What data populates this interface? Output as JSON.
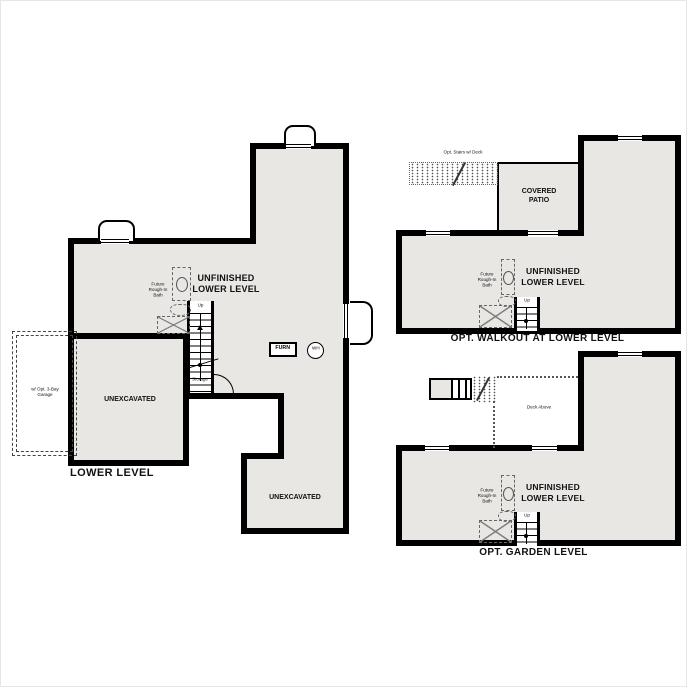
{
  "colors": {
    "wall": "#000000",
    "floor": "#e8e7e4",
    "background": "#ffffff"
  },
  "labels": {
    "unfinished": "UNFINISHED LOWER LEVEL",
    "unexcavated": "UNEXCAVATED",
    "bath": "Future Rough-In Bath",
    "up": "Up",
    "storage": "Storage",
    "furnace": "FURN",
    "water_heater": "WH",
    "garage": "w/ Opt. 3-Bay Garage",
    "covered_patio": "COVERED PATIO",
    "deck_stairs": "Opt. Stairs w/ Deck",
    "deck_above": "Deck Above"
  },
  "plans": {
    "lower_level": {
      "title": "LOWER LEVEL"
    },
    "walkout": {
      "title": "OPT. WALKOUT AT LOWER LEVEL"
    },
    "garden": {
      "title": "OPT. GARDEN LEVEL"
    }
  }
}
